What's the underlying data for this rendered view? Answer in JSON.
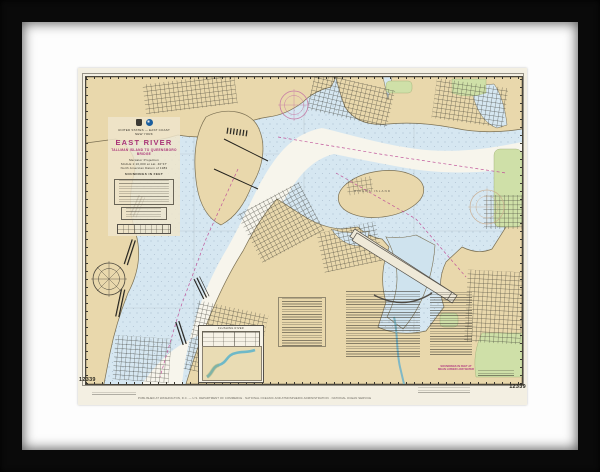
{
  "artwork": {
    "kind": "framed-nautical-chart",
    "chart_number": "12339",
    "title_block": {
      "country": "UNITED STATES — EAST COAST",
      "state": "NEW YORK",
      "title": "EAST RIVER",
      "subtitle": "TALLMAN ISLAND TO QUEENSBORO BRIDGE",
      "projection": "Mercator Projection",
      "scale": "SCALE 1:10,000 at Lat. 40°47'",
      "datum": "North American Datum of 1983",
      "soundings": "SOUNDINGS IN FEET"
    },
    "labels": {
      "rikers_island": "RIKERS ISLAND",
      "inset_caption": "FLUSHING RIVER"
    },
    "margin": {
      "number_left": "12339",
      "number_right": "12339",
      "soundings_note": "SOUNDINGS IN FEET AT MEAN LOWER LOW WATER",
      "imprint": "PUBLISHED AT WASHINGTON, D.C. — U.S. DEPARTMENT OF COMMERCE · NATIONAL OCEANIC AND ATMOSPHERIC ADMINISTRATION · NATIONAL OCEAN SERVICE"
    },
    "colors": {
      "frame": "#0a0a0a",
      "mat": "#fdfdfd",
      "paper": "#f3efe2",
      "land": "#e9d8ac",
      "water_shallow": "#d6e7f1",
      "water_channel": "#f7f5ec",
      "park": "#cfe0a8",
      "magenta": "#a93377",
      "ink": "#3a372f"
    }
  }
}
